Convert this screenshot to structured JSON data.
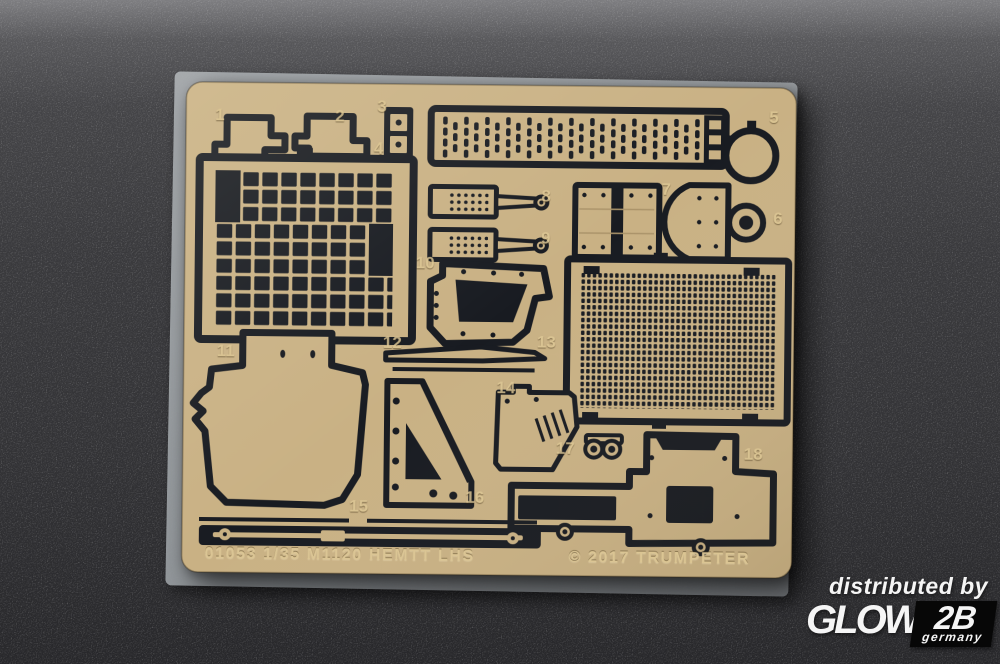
{
  "colors": {
    "fret_brass": "#c9b184",
    "etch": "#181b21",
    "label_tan": "#ddc795",
    "background": "#3a3a3d",
    "film": "#9ba0a4",
    "watermark_white": "#f5f5f5"
  },
  "fret": {
    "footer_left": "01053 1/35 M1120 HEMTT LHS",
    "footer_right": "© 2017 TRUMPETER",
    "part_labels": [
      {
        "n": "1",
        "x": 30,
        "y": 24
      },
      {
        "n": "2",
        "x": 150,
        "y": 24
      },
      {
        "n": "3",
        "x": 192,
        "y": 14
      },
      {
        "n": "4",
        "x": 189,
        "y": 56
      },
      {
        "n": "5",
        "x": 584,
        "y": 21
      },
      {
        "n": "6",
        "x": 589,
        "y": 122
      },
      {
        "n": "7",
        "x": 477,
        "y": 94
      },
      {
        "n": "8",
        "x": 357,
        "y": 102
      },
      {
        "n": "9",
        "x": 357,
        "y": 144
      },
      {
        "n": "10",
        "x": 232,
        "y": 170
      },
      {
        "n": "11",
        "x": 34,
        "y": 260
      },
      {
        "n": "12",
        "x": 200,
        "y": 250
      },
      {
        "n": "13",
        "x": 354,
        "y": 248
      },
      {
        "n": "14",
        "x": 314,
        "y": 294
      },
      {
        "n": "15",
        "x": 168,
        "y": 414
      },
      {
        "n": "16",
        "x": 284,
        "y": 404
      },
      {
        "n": "17",
        "x": 374,
        "y": 354
      },
      {
        "n": "18",
        "x": 562,
        "y": 358
      }
    ]
  },
  "watermark": {
    "line1": "distributed by",
    "brand_glow": "GLOW",
    "brand_2b": "2B",
    "country": "germany"
  }
}
